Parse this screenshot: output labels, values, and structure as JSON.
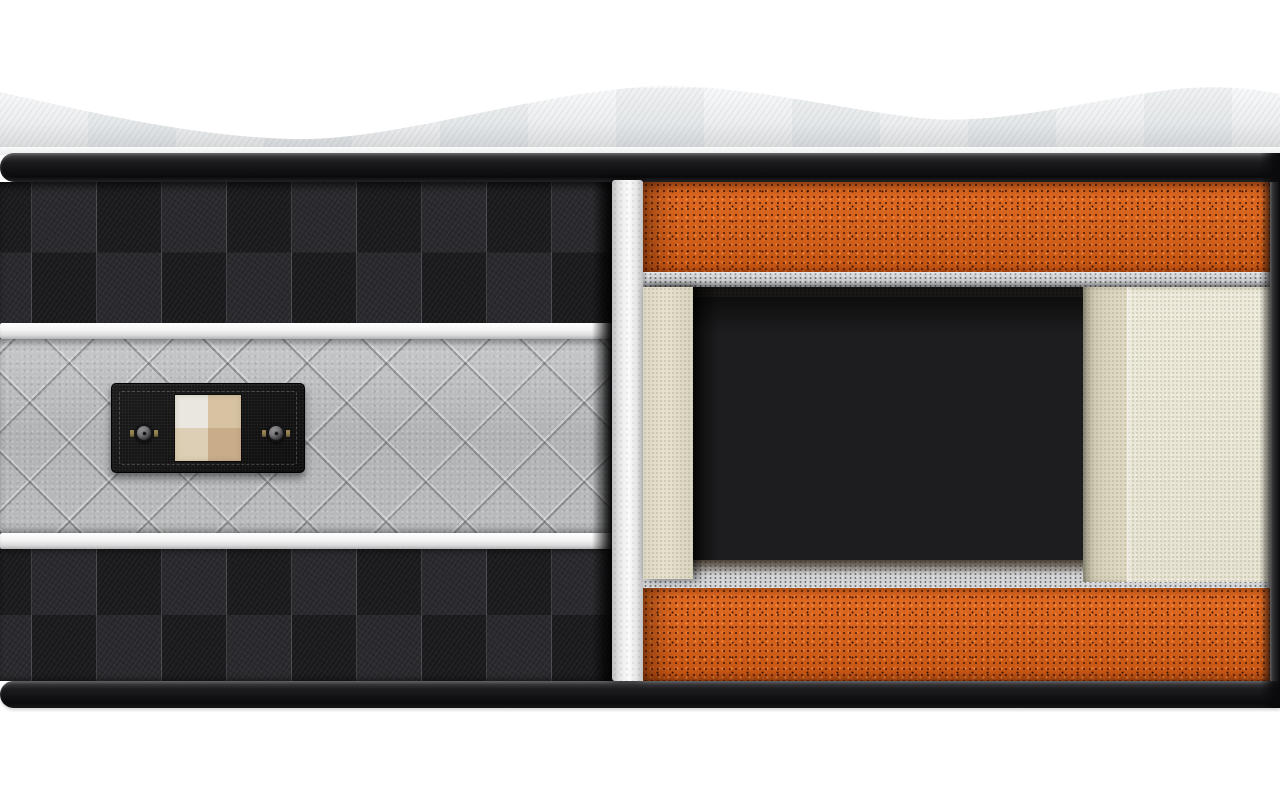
{
  "palette": {
    "page_bg": "#ffffff",
    "fabric_hi": "#f8f9fa",
    "fabric_mid": "#eceef0",
    "fabric_lo": "#d3d5d7",
    "edge_line": "#fafbfb",
    "band_hi": "#46464a",
    "band_dark": "#0a0a0c",
    "checker_dark": "#1b1b1e",
    "checker_light": "#2a2a2e",
    "stitch": "rgba(205,205,215,0.2)",
    "piping_hi": "#ffffff",
    "piping_lo": "#c2c2c4",
    "quilt_hi": "#c6c8ca",
    "quilt_base": "#b0b2b4",
    "plate_bg": "#141414",
    "swatch_tl": "#e9e7e0",
    "swatch_tr": "#d7c3a2",
    "swatch_bl": "#ddcfb5",
    "swatch_br": "#c9ad8a",
    "button_ring": "#77777a",
    "button_face": "#3e3e41",
    "button_clip": "#8c7a4b",
    "strip_hi": "#fbfbfc",
    "strip_lo": "#c0c0c2",
    "orange_hi": "#e06a22",
    "orange_base": "#d2611c",
    "felt_hi": "#d6d7d8",
    "felt_lo": "#c3c4c6",
    "felt_speck": "#5a5b5f",
    "cream_wall": "#e6e2cf",
    "cream_side": "#d9d4bd",
    "cream_front": "#edeadb",
    "cavity_bg": "#1d1d1f",
    "spring_hi": "#f2f2f0",
    "spring_lo": "#8a8a88"
  },
  "scene": {
    "pocket_springs": {
      "count": 6
    },
    "label_plate": {
      "button_count": 2,
      "swatch_quadrants": {
        "top_left": "#e9e7e0",
        "top_right": "#d7c3a2",
        "bottom_left": "#ddcfb5",
        "bottom_right": "#c9ad8a"
      }
    }
  }
}
